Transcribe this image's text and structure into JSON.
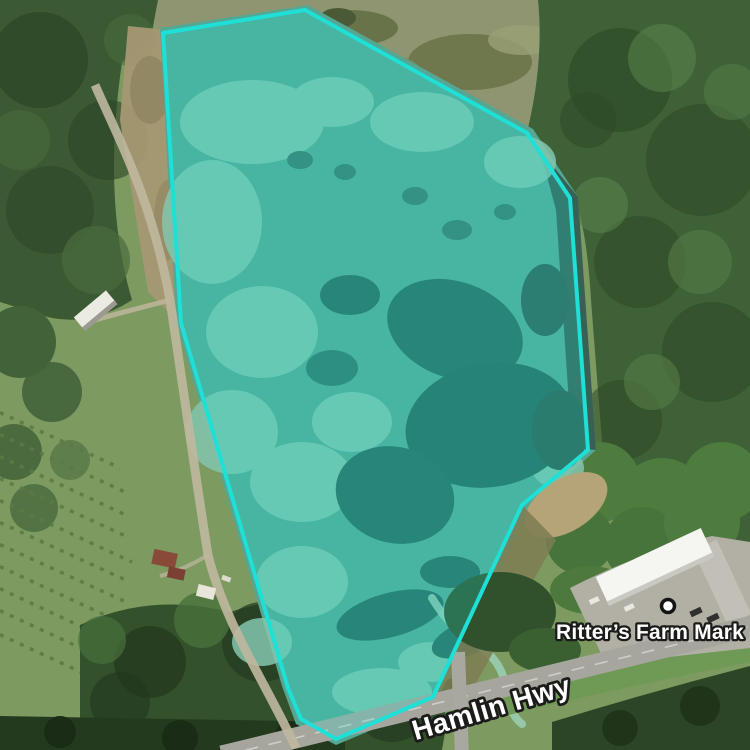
{
  "view": {
    "type": "satellite-map",
    "width": 750,
    "height": 750
  },
  "palette": {
    "overlay_stroke": "#1ee0d6",
    "overlay_fill": "#1ee0d6",
    "label_fill": "#ffffff",
    "label_halo": "#1b1b19"
  },
  "overlay": {
    "name": "highlighted-parcel",
    "fill_opacity": 0.24,
    "stroke_width": 4,
    "points": [
      [
        305,
        10
      ],
      [
        527,
        133
      ],
      [
        570,
        198
      ],
      [
        588,
        450
      ],
      [
        522,
        505
      ],
      [
        433,
        697
      ],
      [
        336,
        739
      ],
      [
        301,
        719
      ],
      [
        288,
        688
      ],
      [
        181,
        323
      ],
      [
        163,
        33
      ]
    ]
  },
  "poi": {
    "label": "Ritter’s Farm Mark",
    "marker": {
      "x": 668,
      "y": 606
    },
    "label_pos": {
      "x": 556,
      "y": 639
    }
  },
  "road": {
    "label": "Hamlin Hwy",
    "label_pos": {
      "x": 494,
      "y": 717
    },
    "label_rotation": -16.5
  }
}
